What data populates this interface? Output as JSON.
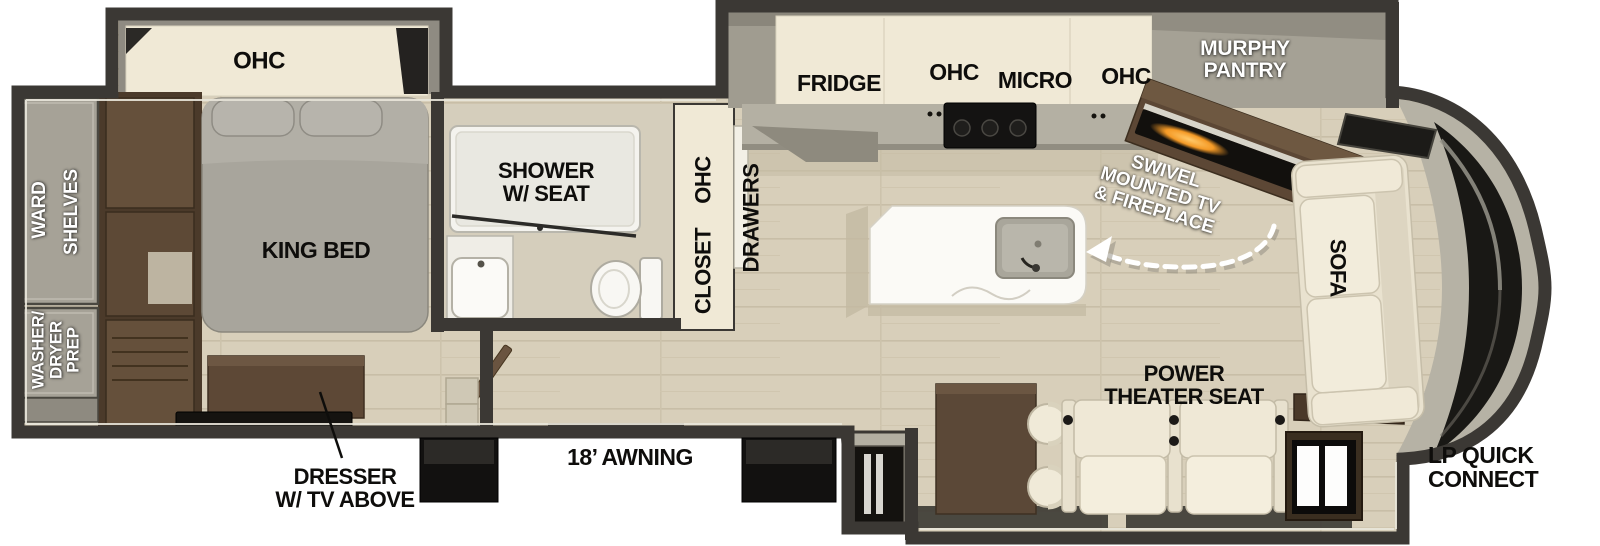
{
  "plan": {
    "bedroom": {
      "ohc": "OHC",
      "king_bed": "KING BED",
      "ward": "WARD",
      "shelves": "SHELVES",
      "washer_dryer_prep": [
        "WASHER/",
        "DRYER",
        "PREP"
      ],
      "dresser": [
        "DRESSER",
        "W/ TV ABOVE"
      ]
    },
    "bathroom": {
      "shower": [
        "SHOWER",
        "W/ SEAT"
      ],
      "ohc": "OHC",
      "closet": "CLOSET",
      "drawers": "DRAWERS"
    },
    "kitchen": {
      "fridge": "FRIDGE",
      "ohc_left": "OHC",
      "micro": "MICRO",
      "ohc_right": "OHC",
      "murphy_pantry": [
        "MURPHY",
        "PANTRY"
      ],
      "swivel_tv": [
        "SWIVEL",
        "MOUNTED TV",
        "& FIREPLACE"
      ]
    },
    "living": {
      "sofa": "SOFA",
      "power_theater_seat": [
        "POWER",
        "THEATER SEAT"
      ]
    },
    "exterior": {
      "awning": "18’ AWNING",
      "lp_quick_connect": [
        "LP QUICK",
        "CONNECT"
      ]
    },
    "colors": {
      "walls": "#3b3834",
      "floor": "#d8cfba",
      "cabinet_cream": "#f0e9d6",
      "furniture_brown": "#5b4735",
      "fixture_white": "#f6f5f1",
      "fireplace_glow": "#f59a26",
      "label_black": "#0e0d0b",
      "label_white": "#ffffff"
    }
  }
}
